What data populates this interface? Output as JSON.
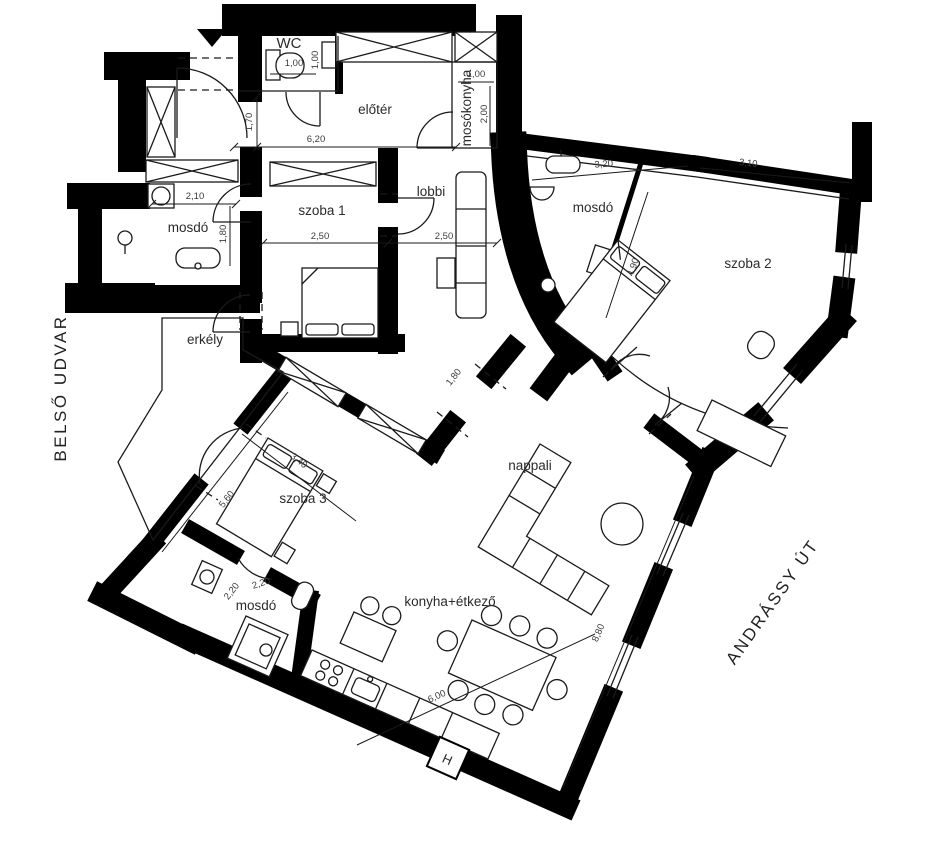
{
  "labels": {
    "street": "ANDRÁSSY ÚT",
    "courtyard": "BELSŐ UDVAR"
  },
  "rooms": {
    "wc": "WC",
    "eloter": "előtér",
    "mosokonyha": "mosókonyha",
    "mosdo1": "mosdó",
    "szoba1": "szoba 1",
    "lobbi": "lobbi",
    "mosdo2": "mosdó",
    "szoba2": "szoba 2",
    "erkely": "erkély",
    "szoba3": "szoba 3",
    "mosdo3": "mosdó",
    "nappali": "nappali",
    "konyha": "konyha+étkező"
  },
  "dimensions": {
    "wc_w": "1,00",
    "wc_d": "1,00",
    "eloter_d": "1,70",
    "eloter_w": "6,20",
    "mosokonyha_w": "1,00",
    "mosokonyha_d": "2,00",
    "mosdo1_w": "2,10",
    "mosdo1_d": "1,80",
    "szoba1_a": "2,50",
    "szoba1_b": "2,50",
    "mosdo2_w": "3,20",
    "szoba2_w": "3,10",
    "szoba2_d": "4,90",
    "szoba3_nw": "5,60",
    "szoba3_bed": "3,40",
    "mosdo3_a": "2,20",
    "mosdo3_b": "2,20",
    "lobbi_opening": "1,80",
    "nappali_e": "8,80",
    "konyha_l": "6,00"
  },
  "annotations": {
    "shaft": "H"
  },
  "colors": {
    "wall": "#000000",
    "line": "#1a1a1a",
    "text": "#2b2b2b",
    "bg": "#ffffff"
  }
}
